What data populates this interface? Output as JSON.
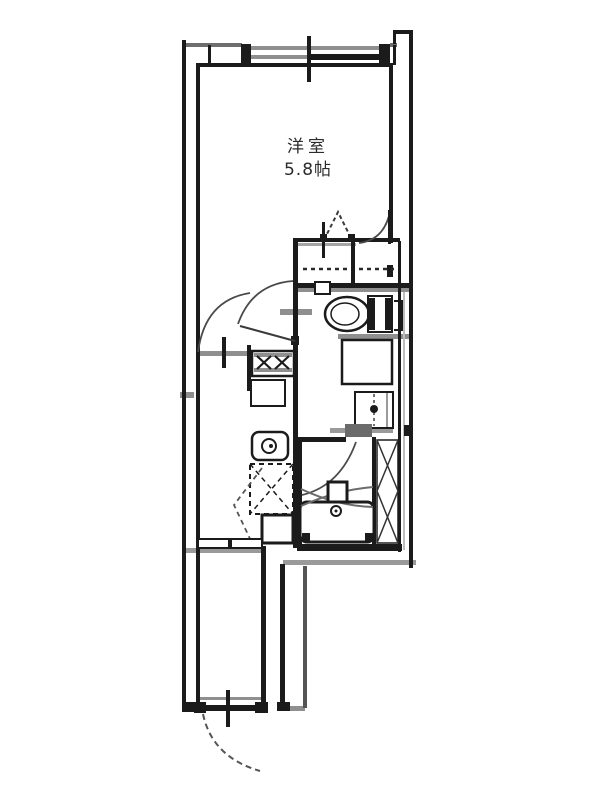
{
  "room_label": {
    "name": "洋室",
    "size": "5.8帖"
  },
  "colors": {
    "background": "#ffffff",
    "wall": "#1b1b1b",
    "shadow": "#8f8f8f",
    "light_shadow": "#bdbdbd",
    "door_arc": "#4a4a4a",
    "label_text": "#2b2b2b"
  },
  "fixtures": [
    "sliding-window",
    "closet-folding-door",
    "closet-hinged-door",
    "toilet",
    "vanity-counter",
    "washbasin",
    "bath-door",
    "bathtub",
    "bath-faucet",
    "pipe-space-shaft",
    "gas-stove",
    "kitchen-counter",
    "kitchen-sink",
    "refrigerator-space",
    "storage-box",
    "room-door",
    "hall-door",
    "entrance-door"
  ]
}
